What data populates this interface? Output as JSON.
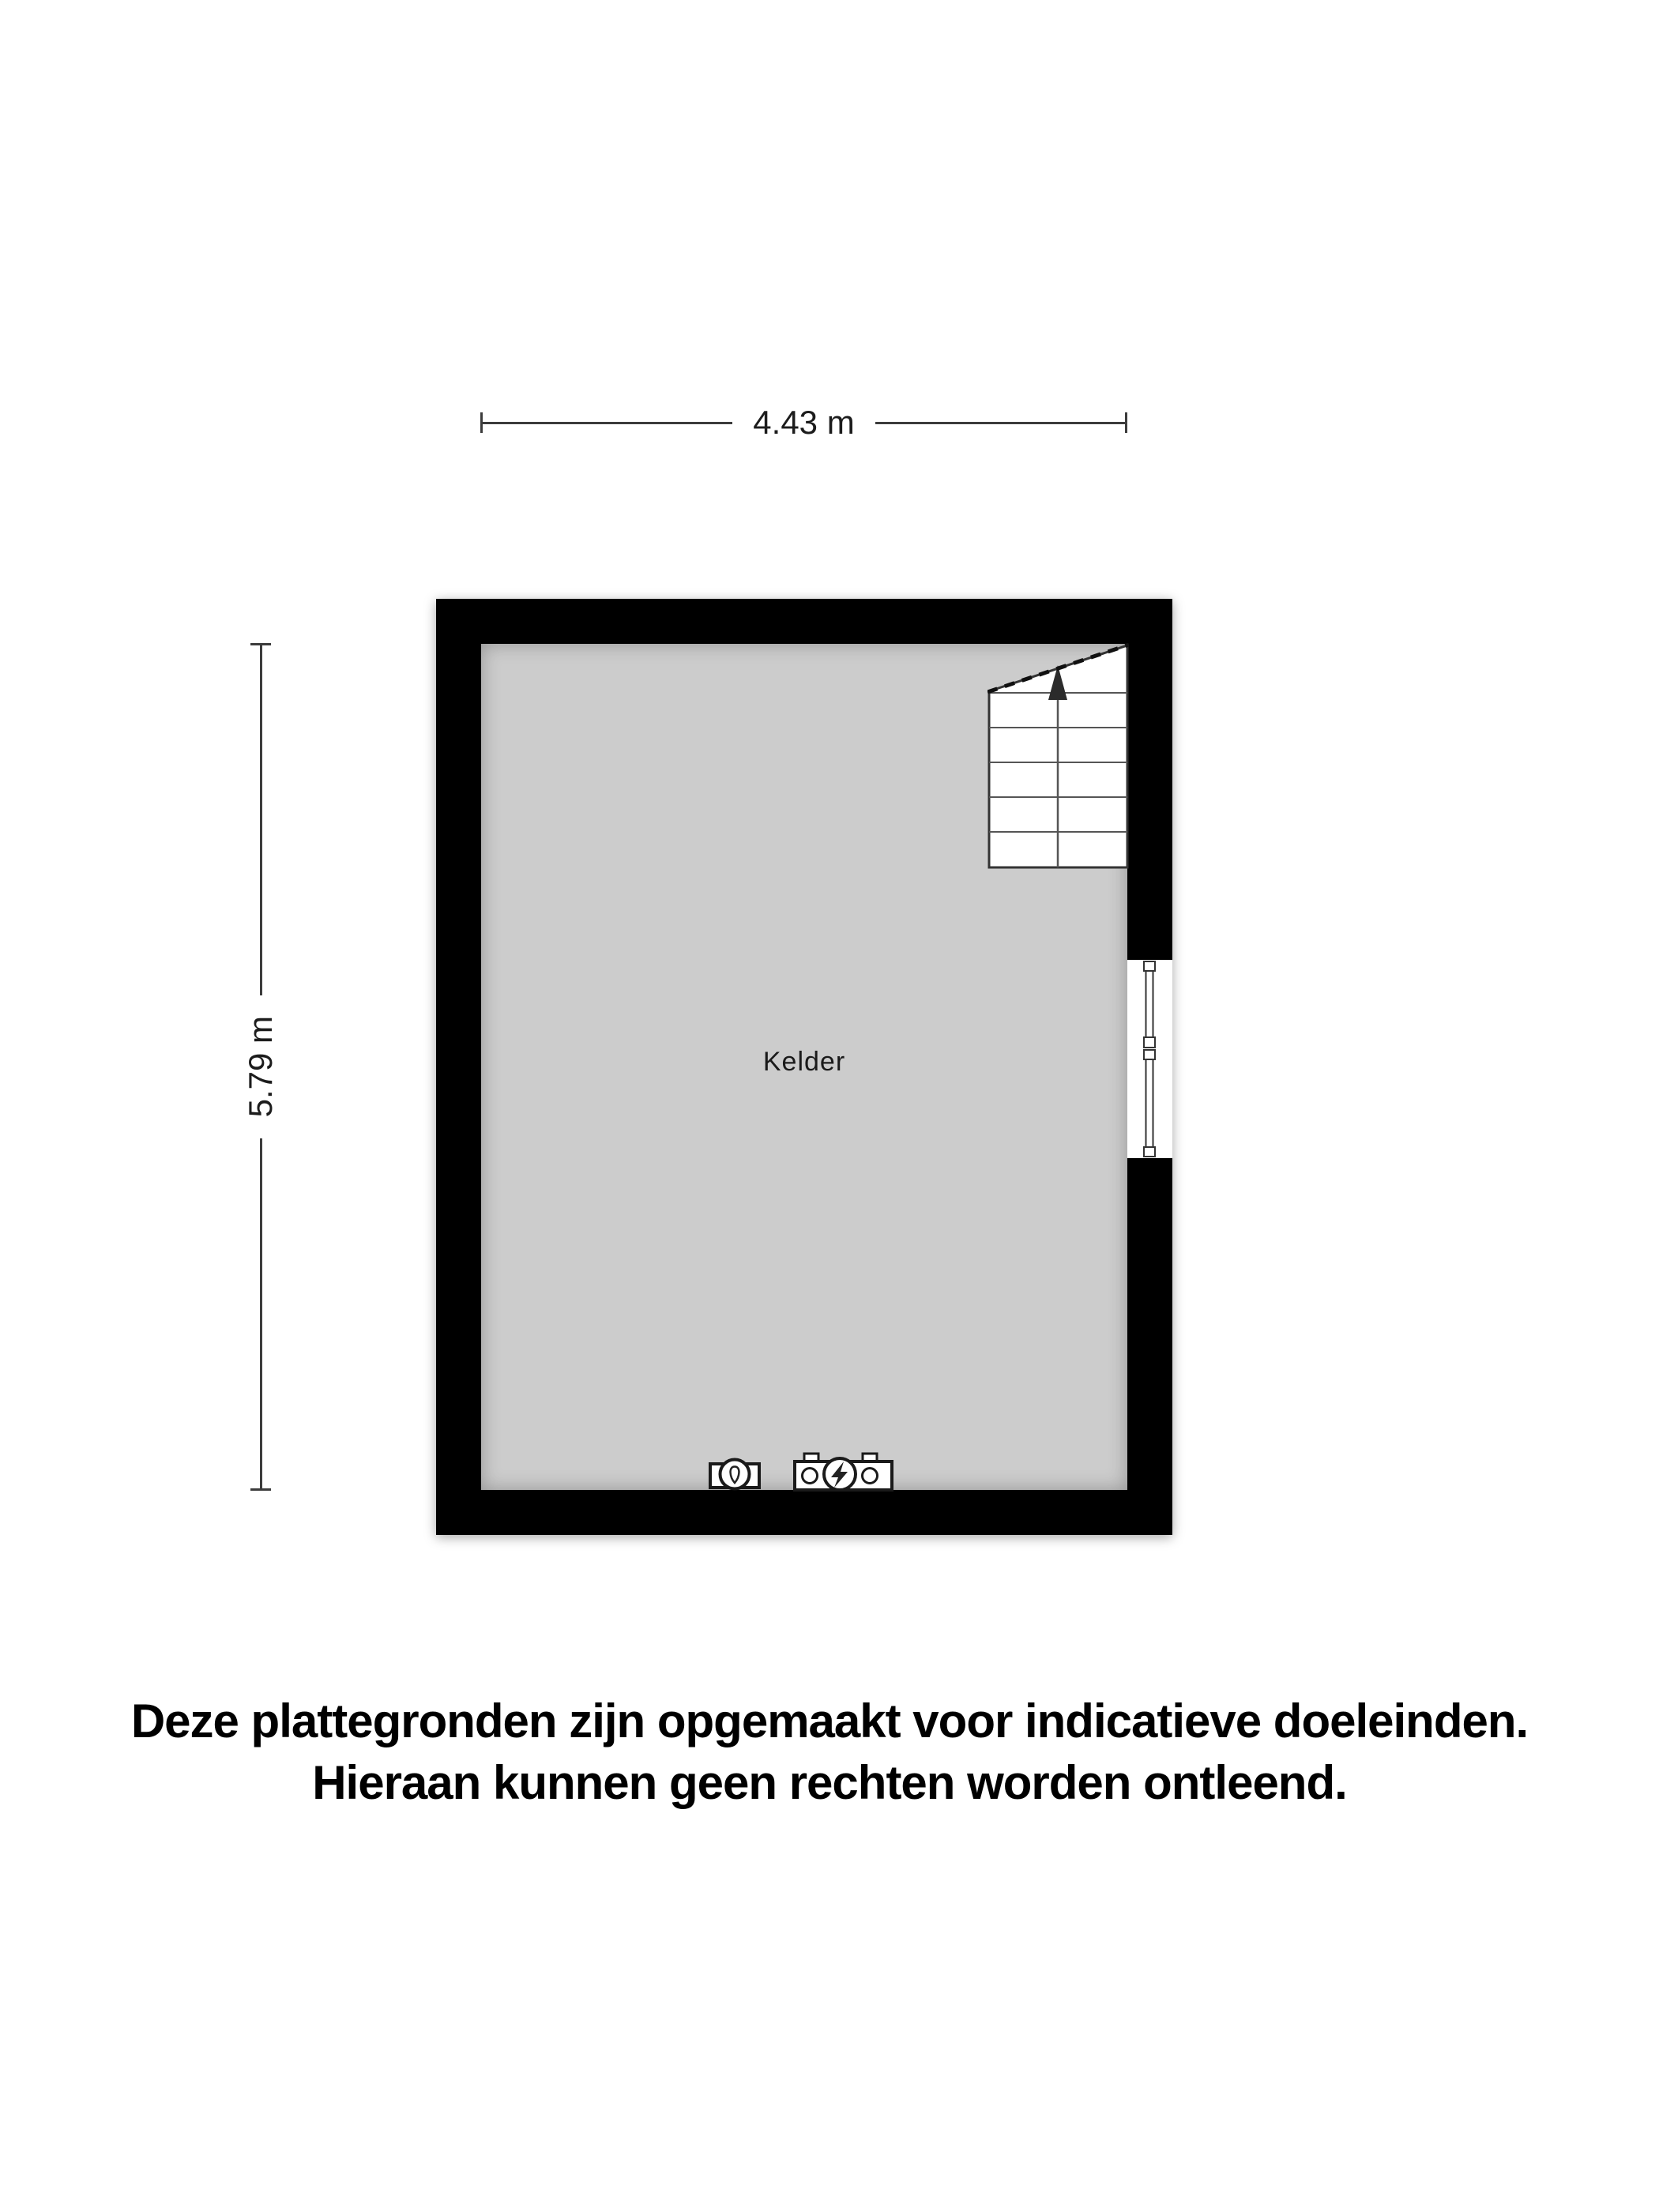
{
  "floorplan": {
    "room_label": "Kelder",
    "dimensions": {
      "width": "4.43 m",
      "height": "5.79 m"
    },
    "colors": {
      "wall": "#000000",
      "floor": "#cccccc",
      "background": "#ffffff",
      "dimension_line": "#3c3c3c"
    },
    "features": {
      "stairs": {
        "icon": "stairs-up-icon",
        "position": "top-right",
        "direction_arrow": "up"
      },
      "window": {
        "icon": "window-icon",
        "position": "right-wall"
      },
      "fixtures": [
        {
          "icon": "water-meter-icon"
        },
        {
          "icon": "electricity-meter-icon"
        }
      ]
    }
  },
  "disclaimer": {
    "line1": "Deze plattegronden zijn opgemaakt voor indicatieve doeleinden.",
    "line2": "Hieraan kunnen geen rechten worden ontleend."
  }
}
